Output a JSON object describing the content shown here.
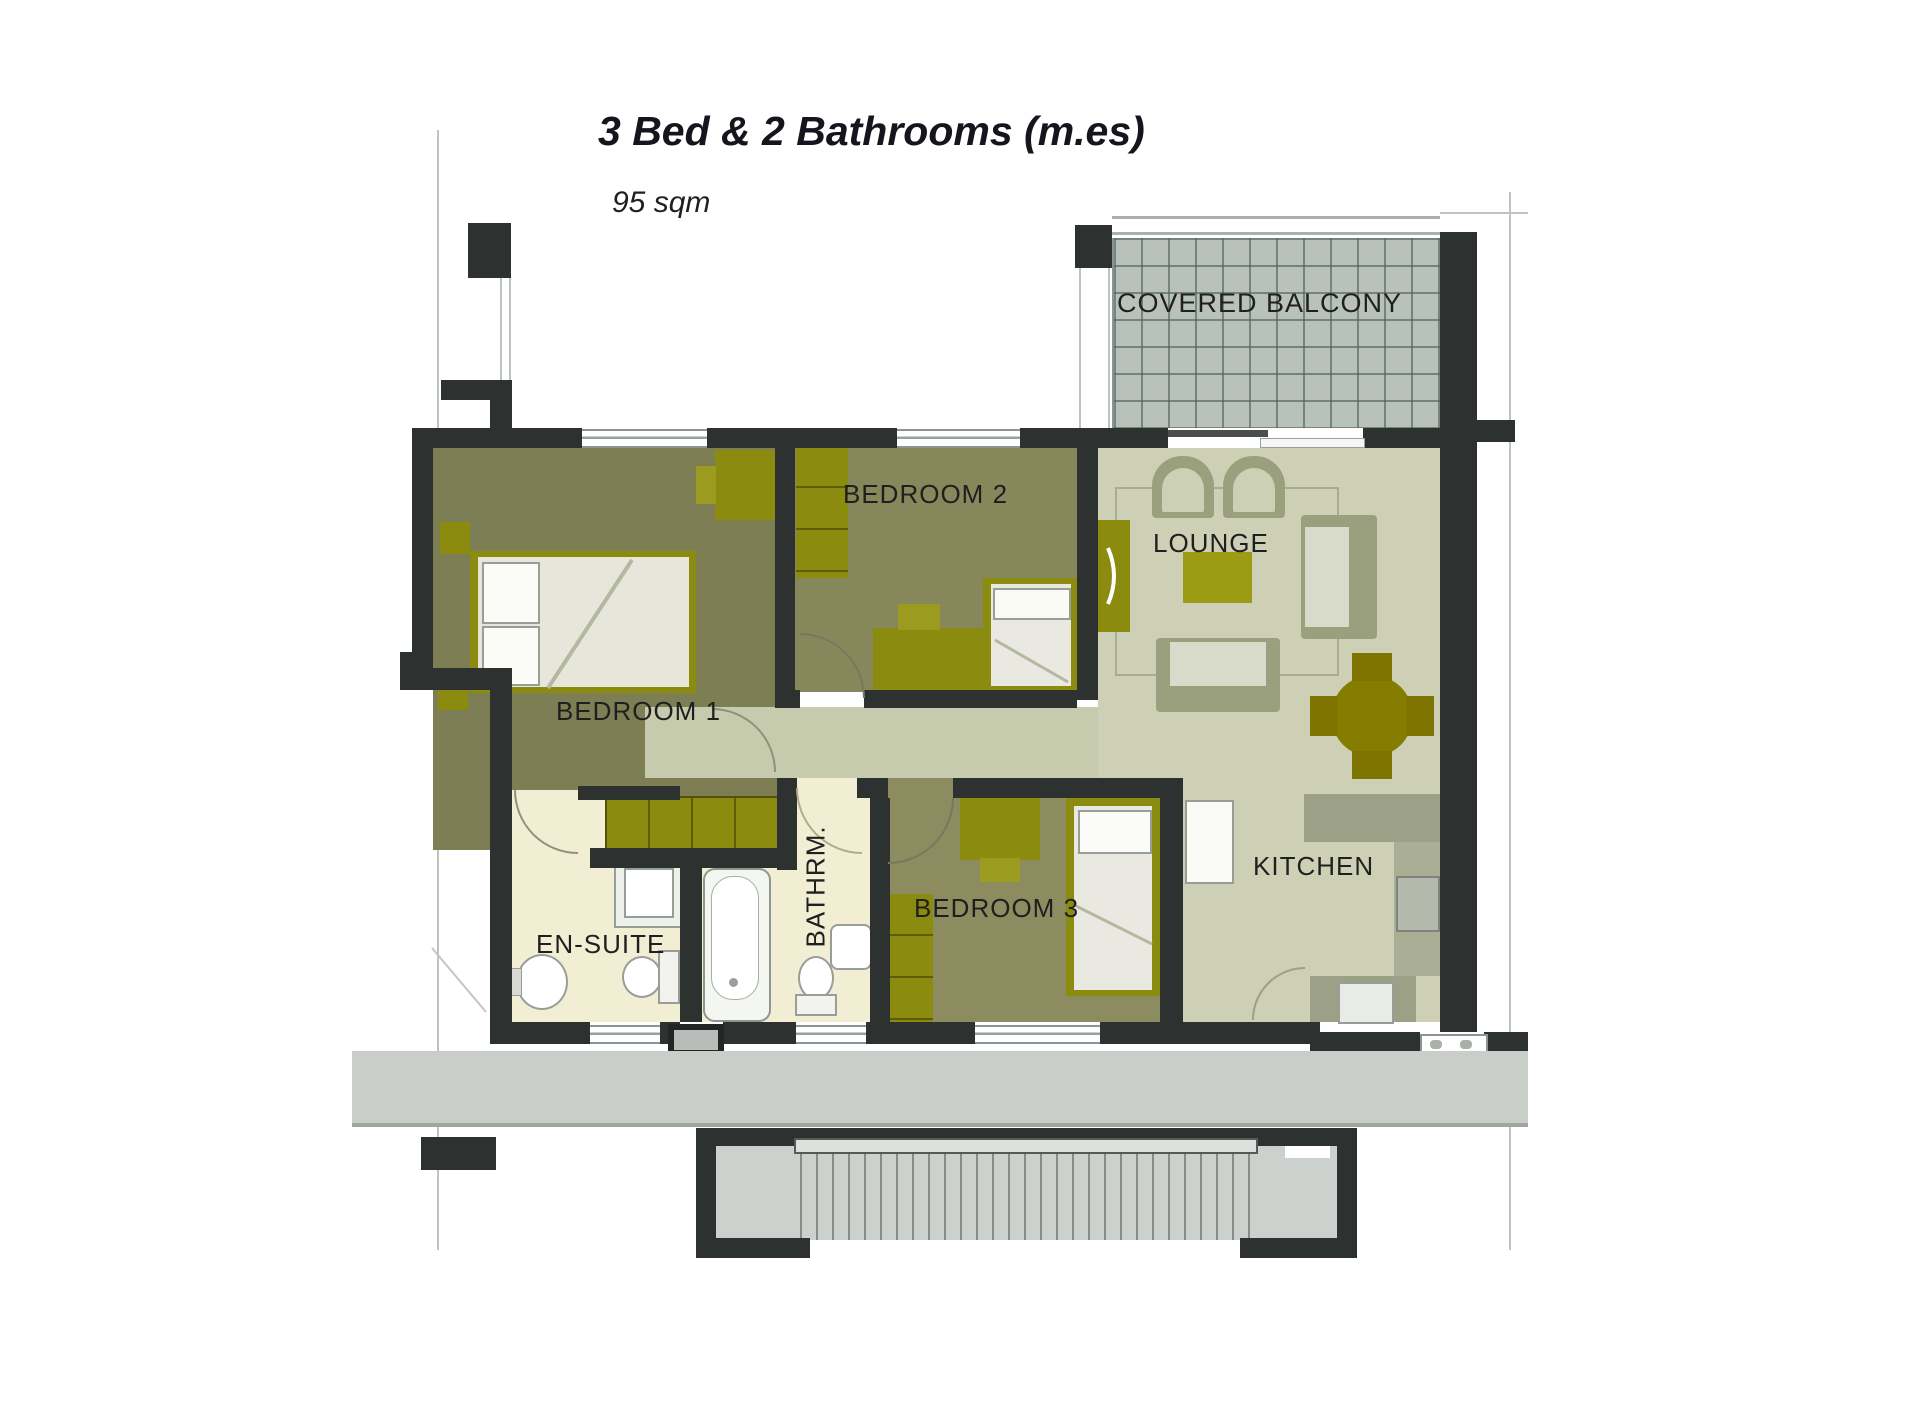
{
  "header": {
    "title": "3 Bed & 2 Bathrooms (m.es)",
    "subtitle": "95 sqm"
  },
  "rooms": {
    "covered_balcony": {
      "label": "COVERED BALCONY"
    },
    "bedroom1": {
      "label": "BEDROOM 1"
    },
    "bedroom2": {
      "label": "BEDROOM 2"
    },
    "bedroom3": {
      "label": "BEDROOM 3"
    },
    "lounge": {
      "label": "LOUNGE"
    },
    "kitchen": {
      "label": "KITCHEN"
    },
    "ensuite": {
      "label": "EN-SUITE"
    },
    "bathroom": {
      "label": "BATHRM."
    }
  },
  "colors": {
    "wall": "#2d312f",
    "bedroom_floor": "#7e7e54",
    "living_floor": "#cdd0b5",
    "bathroom_floor": "#f2eed4",
    "balcony_tile": "#b9c2ba",
    "furniture_olive": "#8b8b10",
    "sofa_sage": "#9aa07e",
    "corridor": "#c9cec9"
  }
}
